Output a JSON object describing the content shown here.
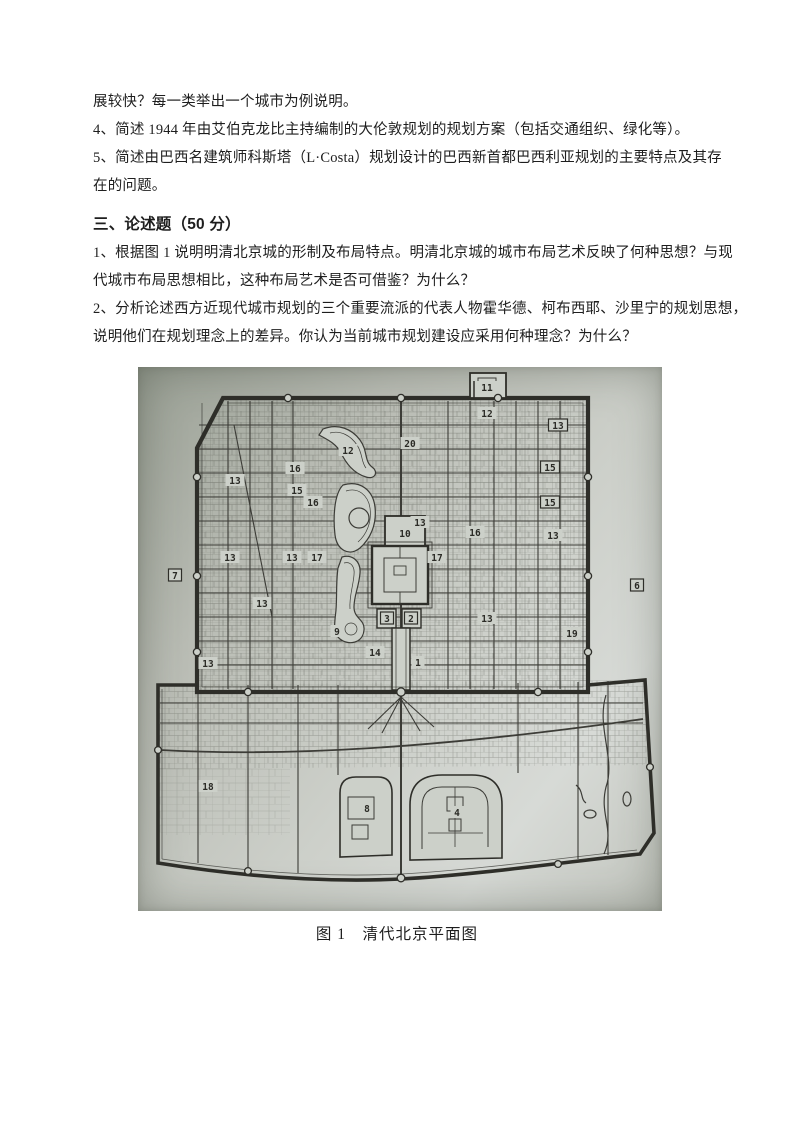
{
  "page": {
    "background": "#ffffff",
    "text_color": "#1e1e1e"
  },
  "doc": {
    "intro_lines": [
      "展较快？每一类举出一个城市为例说明。",
      "4、简述 1944 年由艾伯克龙比主持编制的大伦敦规划的规划方案（包括交通组织、绿化等）。",
      "5、简述由巴西名建筑师科斯塔（L·Costa）规划设计的巴西新首都巴西利亚规划的主要特点及其存",
      "在的问题。"
    ],
    "heading": "三、论述题（50 分）",
    "essay_lines": [
      "1、根据图 1 说明明清北京城的形制及布局特点。明清北京城的城市布局艺术反映了何种思想？与现",
      "代城市布局思想相比，这种布局艺术是否可借鉴？为什么？",
      "2、分析论述西方近现代城市规划的三个重要流派的代表人物霍华德、柯布西耶、沙里宁的规划思想，",
      "说明他们在规划理念上的差异。你认为当前城市规划建设应采用何种理念？为什么？"
    ]
  },
  "figure": {
    "caption": "图 1　清代北京平面图",
    "scan_background": "#c4c7c0",
    "ink_color": "#3c3c37",
    "map_labels": [
      {
        "n": "11",
        "x": 349,
        "y": 21,
        "boxed": false
      },
      {
        "n": "12",
        "x": 349,
        "y": 47,
        "boxed": false
      },
      {
        "n": "13",
        "x": 420,
        "y": 59,
        "boxed": true
      },
      {
        "n": "20",
        "x": 272,
        "y": 77,
        "boxed": false
      },
      {
        "n": "12",
        "x": 210,
        "y": 84,
        "boxed": false
      },
      {
        "n": "15",
        "x": 412,
        "y": 101,
        "boxed": true
      },
      {
        "n": "16",
        "x": 157,
        "y": 102,
        "boxed": false
      },
      {
        "n": "13",
        "x": 97,
        "y": 114,
        "boxed": false
      },
      {
        "n": "15",
        "x": 159,
        "y": 124,
        "boxed": false
      },
      {
        "n": "16",
        "x": 175,
        "y": 136,
        "boxed": false
      },
      {
        "n": "15",
        "x": 412,
        "y": 136,
        "boxed": true
      },
      {
        "n": "13",
        "x": 282,
        "y": 156,
        "boxed": false
      },
      {
        "n": "16",
        "x": 337,
        "y": 166,
        "boxed": false
      },
      {
        "n": "10",
        "x": 267,
        "y": 167,
        "boxed": false
      },
      {
        "n": "13",
        "x": 415,
        "y": 169,
        "boxed": false
      },
      {
        "n": "13",
        "x": 92,
        "y": 191,
        "boxed": false
      },
      {
        "n": "13",
        "x": 154,
        "y": 191,
        "boxed": false
      },
      {
        "n": "17",
        "x": 179,
        "y": 191,
        "boxed": false
      },
      {
        "n": "17",
        "x": 299,
        "y": 191,
        "boxed": false
      },
      {
        "n": "7",
        "x": 37,
        "y": 209,
        "boxed": true
      },
      {
        "n": "6",
        "x": 499,
        "y": 219,
        "boxed": true
      },
      {
        "n": "13",
        "x": 124,
        "y": 237,
        "boxed": false
      },
      {
        "n": "3",
        "x": 249,
        "y": 252,
        "boxed": true
      },
      {
        "n": "2",
        "x": 273,
        "y": 252,
        "boxed": true
      },
      {
        "n": "13",
        "x": 349,
        "y": 252,
        "boxed": false
      },
      {
        "n": "9",
        "x": 199,
        "y": 265,
        "boxed": false
      },
      {
        "n": "19",
        "x": 434,
        "y": 267,
        "boxed": false
      },
      {
        "n": "14",
        "x": 237,
        "y": 286,
        "boxed": false
      },
      {
        "n": "1",
        "x": 280,
        "y": 296,
        "boxed": false
      },
      {
        "n": "13",
        "x": 70,
        "y": 297,
        "boxed": false
      },
      {
        "n": "18",
        "x": 70,
        "y": 420,
        "boxed": false
      },
      {
        "n": "8",
        "x": 229,
        "y": 442,
        "boxed": false
      },
      {
        "n": "4",
        "x": 319,
        "y": 446,
        "boxed": false
      }
    ]
  }
}
